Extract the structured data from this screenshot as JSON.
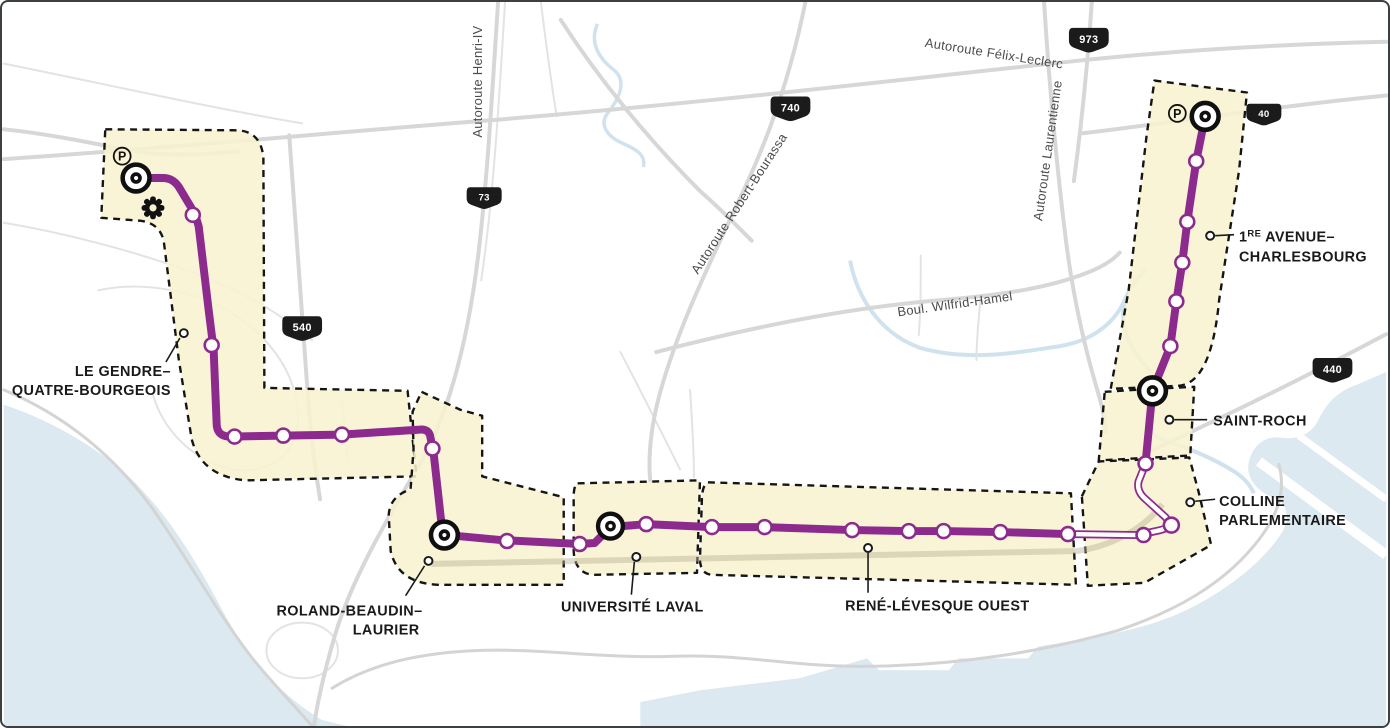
{
  "map_name": "Tramway de Québec — tracé et stations",
  "colors": {
    "line_purple": "#8D2A8E",
    "zone_yellow": "#F8F3CF",
    "zone_border": "#151515",
    "water_blue": "#DDE9F1",
    "road_gray": "#D7D7D7",
    "label_black": "#1A1A1A"
  },
  "stations_labels": {
    "le_gendre": {
      "line1": "LE GENDRE–",
      "line2": "QUATRE-BOURGEOIS"
    },
    "roland": {
      "line1": "ROLAND-BEAUDIN–",
      "line2": "LAURIER"
    },
    "universite": {
      "label": "UNIVERSITÉ LAVAL"
    },
    "rene": {
      "label": "RENÉ-LÉVESQUE OUEST"
    },
    "saint_roch": {
      "label": "SAINT-ROCH"
    },
    "colline": {
      "line1": "COLLINE",
      "line2": "PARLEMENTAIRE"
    },
    "premiere_avenue": {
      "num": "1",
      "sup": "RE",
      "rest": " AVENUE–",
      "line2": "CHARLESBOURG"
    }
  },
  "roads": {
    "henri_iv": "Autoroute Henri-IV",
    "felix_leclerc": "Autoroute Félix-Leclerc",
    "laurentienne": "Autoroute Laurentienne",
    "robert_bourassa": "Autoroute Robert-Bourassa",
    "wilfrid_hamel": "Boul. Wilfrid-Hamel"
  },
  "shields": {
    "s73": "73",
    "s540": "540",
    "s740": "740",
    "s973": "973",
    "s40": "40",
    "s440": "440"
  },
  "icons": {
    "parking": "P"
  }
}
